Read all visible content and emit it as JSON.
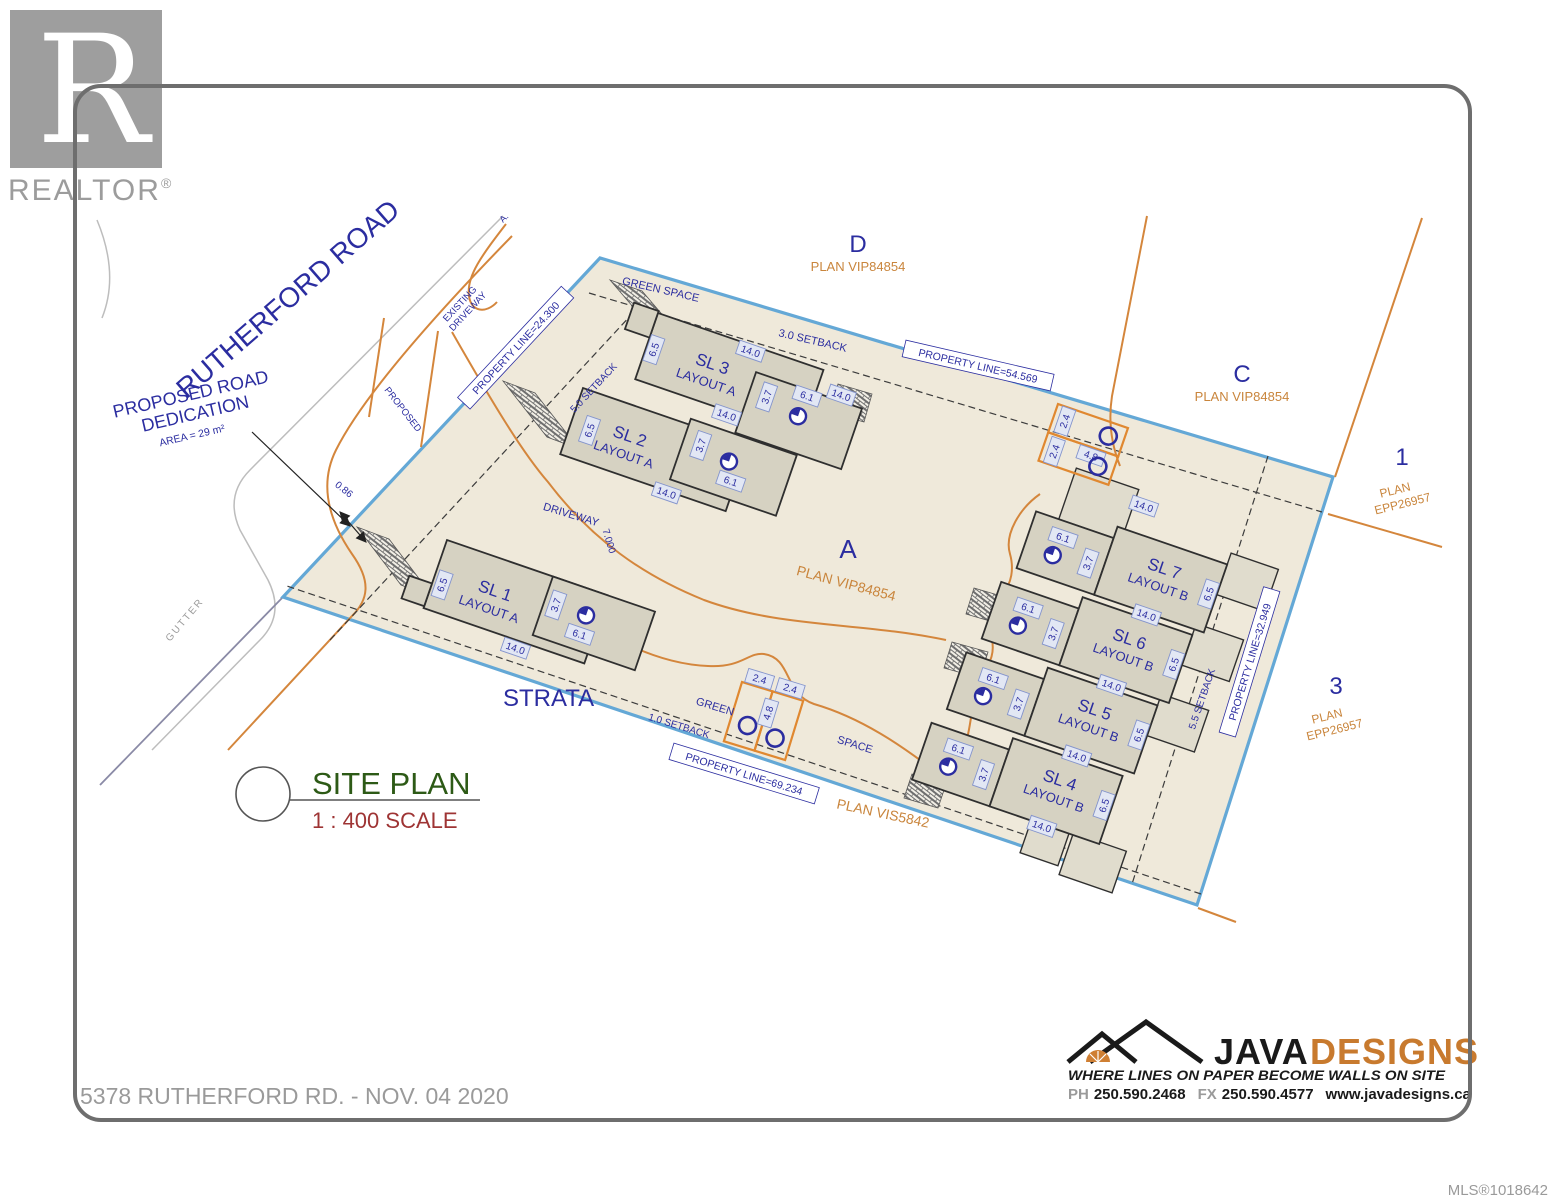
{
  "branding": {
    "realtor": "REALTOR",
    "reg": "®"
  },
  "roads": {
    "rutherford": "RUTHERFORD ROAD",
    "dedication_line1": "PROPOSED ROAD",
    "dedication_line2": "DEDICATION",
    "dedication_area": "AREA = 29 m²",
    "existing_line1": "EXISTING",
    "existing_line2": "DRIVEWAY",
    "proposed": "PROPOSED",
    "gutter": "GUTTER",
    "partial_label": "A."
  },
  "parcels": {
    "d": {
      "name": "D",
      "plan": "PLAN VIP84854"
    },
    "c": {
      "name": "C",
      "plan": "PLAN VIP84854"
    },
    "a": {
      "name": "A",
      "plan": "PLAN VIP84854"
    },
    "lot1": {
      "name": "1",
      "plan_line1": "PLAN",
      "plan_line2": "EPP26957"
    },
    "lot3": {
      "name": "3",
      "plan_line1": "PLAN",
      "plan_line2": "EPP26957"
    },
    "south_plan": "PLAN VIS5842"
  },
  "property_lines": {
    "nw": "PROPERTY LINE=24.300",
    "top": "PROPERTY LINE=54.569",
    "east": "PROPERTY LINE=32.949",
    "south": "PROPERTY LINE=69.234"
  },
  "setbacks": {
    "top": "3.0 SETBACK",
    "nw": "5.0 SETBACK",
    "south": "1.0 SETBACK",
    "east": "5.5 SETBACK"
  },
  "site": {
    "green_space": "GREEN SPACE",
    "green": "GREEN",
    "space": "SPACE",
    "driveway": "DRIVEWAY",
    "driveway_width": "7.000",
    "strata": "STRATA",
    "dedication_width": "0.86"
  },
  "buildings": [
    {
      "name": "SL 1",
      "layout": "LAYOUT A"
    },
    {
      "name": "SL 2",
      "layout": "LAYOUT A"
    },
    {
      "name": "SL 3",
      "layout": "LAYOUT A"
    },
    {
      "name": "SL 4",
      "layout": "LAYOUT B"
    },
    {
      "name": "SL 5",
      "layout": "LAYOUT B"
    },
    {
      "name": "SL 6",
      "layout": "LAYOUT B"
    },
    {
      "name": "SL 7",
      "layout": "LAYOUT B"
    }
  ],
  "dims": {
    "w": "14.0",
    "d": "6.5",
    "g": "3.7",
    "gl": "6.1",
    "s": "2.4",
    "sl": "4.8"
  },
  "title": {
    "label": "SITE PLAN",
    "scale": "1 : 400 SCALE"
  },
  "footer": {
    "address": "5378 RUTHERFORD RD. - NOV. 04 2020",
    "mls": "MLS®1018642"
  },
  "java": {
    "name1": "JAVA",
    "name2": "DESIGNS",
    "tagline": "WHERE LINES ON PAPER BECOME WALLS ON SITE",
    "ph_label": "PH",
    "phone": "250.590.2468",
    "fx_label": "FX",
    "fax": "250.590.4577",
    "web": "www.javadesigns.ca"
  }
}
